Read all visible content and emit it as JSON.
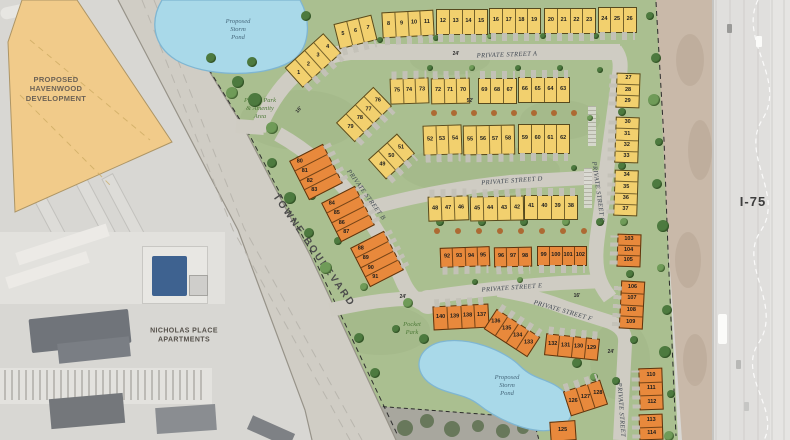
{
  "region_labels": {
    "havenwood": "PROPOSED\nHAVENWOOD\nDEVELOPMENT",
    "nicholas": "NICHOLAS PLACE\nAPARTMENTS",
    "highway": "I-75",
    "towne": "TOWNE BOULEVARD",
    "storm_pond_upper": "Proposed\nStorm\nPond",
    "storm_pond_lower": "Proposed\nStorm\nPond",
    "amenity_park": "Pocket Park\n& Amenity\nArea",
    "pocket_park": "Pocket\nPark"
  },
  "street_labels": [
    {
      "text": "PRIVATE STREET A",
      "x": 507,
      "y": 55,
      "rot": -2
    },
    {
      "text": "PRIVATE STREET B",
      "x": 366,
      "y": 195,
      "rot": 54
    },
    {
      "text": "PRIVATE STREET C",
      "x": 598,
      "y": 192,
      "rot": 82
    },
    {
      "text": "PRIVATE STREET D",
      "x": 512,
      "y": 181,
      "rot": -4
    },
    {
      "text": "PRIVATE STREET E",
      "x": 512,
      "y": 288,
      "rot": -4
    },
    {
      "text": "PRIVATE STREET F",
      "x": 563,
      "y": 311,
      "rot": 16
    },
    {
      "text": "PRIVATE STREET",
      "x": 621,
      "y": 410,
      "rot": 86
    }
  ],
  "dimensions": [
    {
      "text": "24'",
      "x": 456,
      "y": 54,
      "rot": 0
    },
    {
      "text": "16'",
      "x": 299,
      "y": 110,
      "rot": -50
    },
    {
      "text": "52'",
      "x": 470,
      "y": 101,
      "rot": 0
    },
    {
      "text": "24'",
      "x": 403,
      "y": 297,
      "rot": 0
    },
    {
      "text": "16'",
      "x": 577,
      "y": 296,
      "rot": 0
    },
    {
      "text": "24'",
      "x": 611,
      "y": 352,
      "rot": 0
    }
  ],
  "colors": {
    "lot_yellow": "#f2d06e",
    "lot_orange": "#e8893c",
    "grass": "#aabf90",
    "street": "#cfccc3",
    "pond": "#a9d9e9",
    "havenwood_parcel": "#f1cb8a"
  },
  "lot_blocks": [
    {
      "lots": [
        "1",
        "2",
        "3",
        "4"
      ],
      "x": 313,
      "y": 60,
      "rot": -42,
      "cw": 13,
      "ch": 27,
      "drive": "bottom"
    },
    {
      "lots": [
        "5",
        "6",
        "7"
      ],
      "x": 355,
      "y": 32,
      "rot": -14,
      "drive": "bottom"
    },
    {
      "lots": [
        "8",
        "9",
        "10",
        "11"
      ],
      "x": 408,
      "y": 24,
      "rot": -3,
      "drive": "bottom"
    },
    {
      "lots": [
        "12",
        "13",
        "14",
        "15"
      ],
      "x": 462,
      "y": 22,
      "rot": 0,
      "drive": "bottom"
    },
    {
      "lots": [
        "16",
        "17",
        "18",
        "19"
      ],
      "x": 515,
      "y": 21,
      "rot": 0,
      "drive": "bottom"
    },
    {
      "lots": [
        "20",
        "21",
        "22",
        "23"
      ],
      "x": 570,
      "y": 21,
      "rot": 0,
      "drive": "bottom"
    },
    {
      "lots": [
        "24",
        "25",
        "26"
      ],
      "x": 617,
      "y": 20,
      "rot": 0,
      "drive": "bottom"
    },
    {
      "lots": [
        "75",
        "74",
        "73"
      ],
      "x": 409,
      "y": 91,
      "rot": -2,
      "drive": "top"
    },
    {
      "lots": [
        "72",
        "71",
        "70"
      ],
      "x": 450,
      "y": 91,
      "rot": -1,
      "drive": "top"
    },
    {
      "lots": [
        "69",
        "68",
        "67"
      ],
      "x": 497,
      "y": 91,
      "rot": 0,
      "drive": "top"
    },
    {
      "lots": [
        "66",
        "65",
        "64",
        "63"
      ],
      "x": 544,
      "y": 90,
      "rot": 0,
      "drive": "top"
    },
    {
      "lots": [
        "52",
        "53",
        "54"
      ],
      "x": 442,
      "y": 140,
      "ch": 30,
      "rot": -2,
      "drive": "bottom"
    },
    {
      "lots": [
        "55",
        "56",
        "57",
        "58"
      ],
      "x": 489,
      "y": 140,
      "ch": 30,
      "rot": -1,
      "drive": "bottom"
    },
    {
      "lots": [
        "59",
        "60",
        "61",
        "62"
      ],
      "x": 544,
      "y": 139,
      "ch": 30,
      "rot": 0,
      "drive": "bottom"
    },
    {
      "lots": [
        "48",
        "47",
        "46"
      ],
      "x": 448,
      "y": 208,
      "cw": 13.5,
      "ch": 25,
      "rot": -2,
      "drive": "top"
    },
    {
      "lots": [
        "45",
        "44",
        "43",
        "42"
      ],
      "x": 497,
      "y": 208,
      "cw": 13.5,
      "ch": 25,
      "rot": -1,
      "drive": "top"
    },
    {
      "lots": [
        "41",
        "40",
        "39",
        "38"
      ],
      "x": 551,
      "y": 207,
      "cw": 13.5,
      "ch": 25,
      "rot": 0,
      "drive": "top"
    },
    {
      "lots": [
        "92",
        "93",
        "94",
        "95"
      ],
      "x": 465,
      "y": 257,
      "cw": 12.5,
      "ch": 20,
      "rot": -2,
      "color": "orange",
      "drive": "bottom"
    },
    {
      "lots": [
        "96",
        "97",
        "98"
      ],
      "x": 513,
      "y": 257,
      "cw": 12.5,
      "ch": 20,
      "rot": -1,
      "color": "orange",
      "drive": "bottom"
    },
    {
      "lots": [
        "99",
        "100",
        "101",
        "102"
      ],
      "x": 562,
      "y": 256,
      "cw": 12.5,
      "ch": 20,
      "rot": 0,
      "color": "orange",
      "drive": "bottom"
    },
    {
      "lots": [
        "79",
        "78",
        "77",
        "76"
      ],
      "x": 364,
      "y": 114,
      "rot": -44,
      "ch": 27,
      "drive": "bottom"
    },
    {
      "lots": [
        "49",
        "50",
        "51"
      ],
      "x": 391,
      "y": 156,
      "rot": -42,
      "ch": 27,
      "drive": "bottom"
    },
    {
      "lots": [
        "80",
        "81",
        "82",
        "83"
      ],
      "x": 316,
      "y": 172,
      "rot": -27,
      "stack": "col",
      "cw": 38,
      "ch": 11,
      "color": "orange",
      "align": "left",
      "drive": "right"
    },
    {
      "lots": [
        "84",
        "85",
        "86",
        "87"
      ],
      "x": 348,
      "y": 214,
      "rot": -27,
      "stack": "col",
      "cw": 38,
      "ch": 11,
      "color": "orange",
      "align": "left",
      "drive": "right"
    },
    {
      "lots": [
        "88",
        "89",
        "90",
        "91"
      ],
      "x": 377,
      "y": 259,
      "rot": -27,
      "stack": "col",
      "cw": 38,
      "ch": 11,
      "color": "orange",
      "align": "left",
      "drive": "right"
    },
    {
      "lots": [
        "27",
        "28",
        "29"
      ],
      "x": 628,
      "y": 90,
      "stack": "col",
      "cw": 24,
      "ch": 11.5,
      "rot": 2,
      "drive": "left"
    },
    {
      "lots": [
        "30",
        "31",
        "32",
        "33"
      ],
      "x": 627,
      "y": 140,
      "stack": "col",
      "cw": 24,
      "ch": 11.5,
      "rot": 2,
      "drive": "left"
    },
    {
      "lots": [
        "34",
        "35",
        "36",
        "37"
      ],
      "x": 626,
      "y": 193,
      "stack": "col",
      "cw": 24,
      "ch": 11.5,
      "rot": 2,
      "drive": "left"
    },
    {
      "lots": [
        "103",
        "104",
        "105"
      ],
      "x": 629,
      "y": 250,
      "stack": "col",
      "cw": 24,
      "ch": 11,
      "rot": 2,
      "color": "orange",
      "drive": "left"
    },
    {
      "lots": [
        "106",
        "107",
        "108",
        "109"
      ],
      "x": 632,
      "y": 305,
      "stack": "col",
      "cw": 24,
      "ch": 12,
      "rot": 3,
      "color": "orange",
      "drive": "left"
    },
    {
      "lots": [
        "110",
        "111",
        "112"
      ],
      "x": 651,
      "y": 389,
      "stack": "col",
      "cw": 24,
      "ch": 14,
      "rot": -2,
      "color": "orange",
      "drive": "left"
    },
    {
      "lots": [
        "113",
        "114"
      ],
      "x": 651,
      "y": 427,
      "stack": "col",
      "cw": 24,
      "ch": 13,
      "rot": -2,
      "color": "orange",
      "drive": "left"
    },
    {
      "lots": [
        "140",
        "139",
        "138",
        "137"
      ],
      "x": 461,
      "y": 317,
      "cw": 14,
      "ch": 24,
      "rot": -3,
      "color": "orange",
      "drive": "top"
    },
    {
      "lots": [
        "136",
        "135",
        "134",
        "133"
      ],
      "x": 512,
      "y": 333,
      "cw": 13,
      "ch": 24,
      "rot": 33,
      "color": "orange",
      "drive": "top"
    },
    {
      "lots": [
        "132",
        "131",
        "130",
        "129"
      ],
      "x": 572,
      "y": 347,
      "cw": 13.5,
      "ch": 22,
      "rot": 6,
      "color": "orange",
      "drive": "top"
    },
    {
      "lots": [
        "126",
        "127",
        "128"
      ],
      "x": 585,
      "y": 398,
      "cw": 13,
      "ch": 26,
      "rot": -18,
      "color": "orange",
      "drive": "top"
    },
    {
      "lots": [
        "125"
      ],
      "x": 563,
      "y": 431,
      "cw": 26,
      "ch": 20,
      "rot": -4,
      "color": "orange"
    }
  ]
}
